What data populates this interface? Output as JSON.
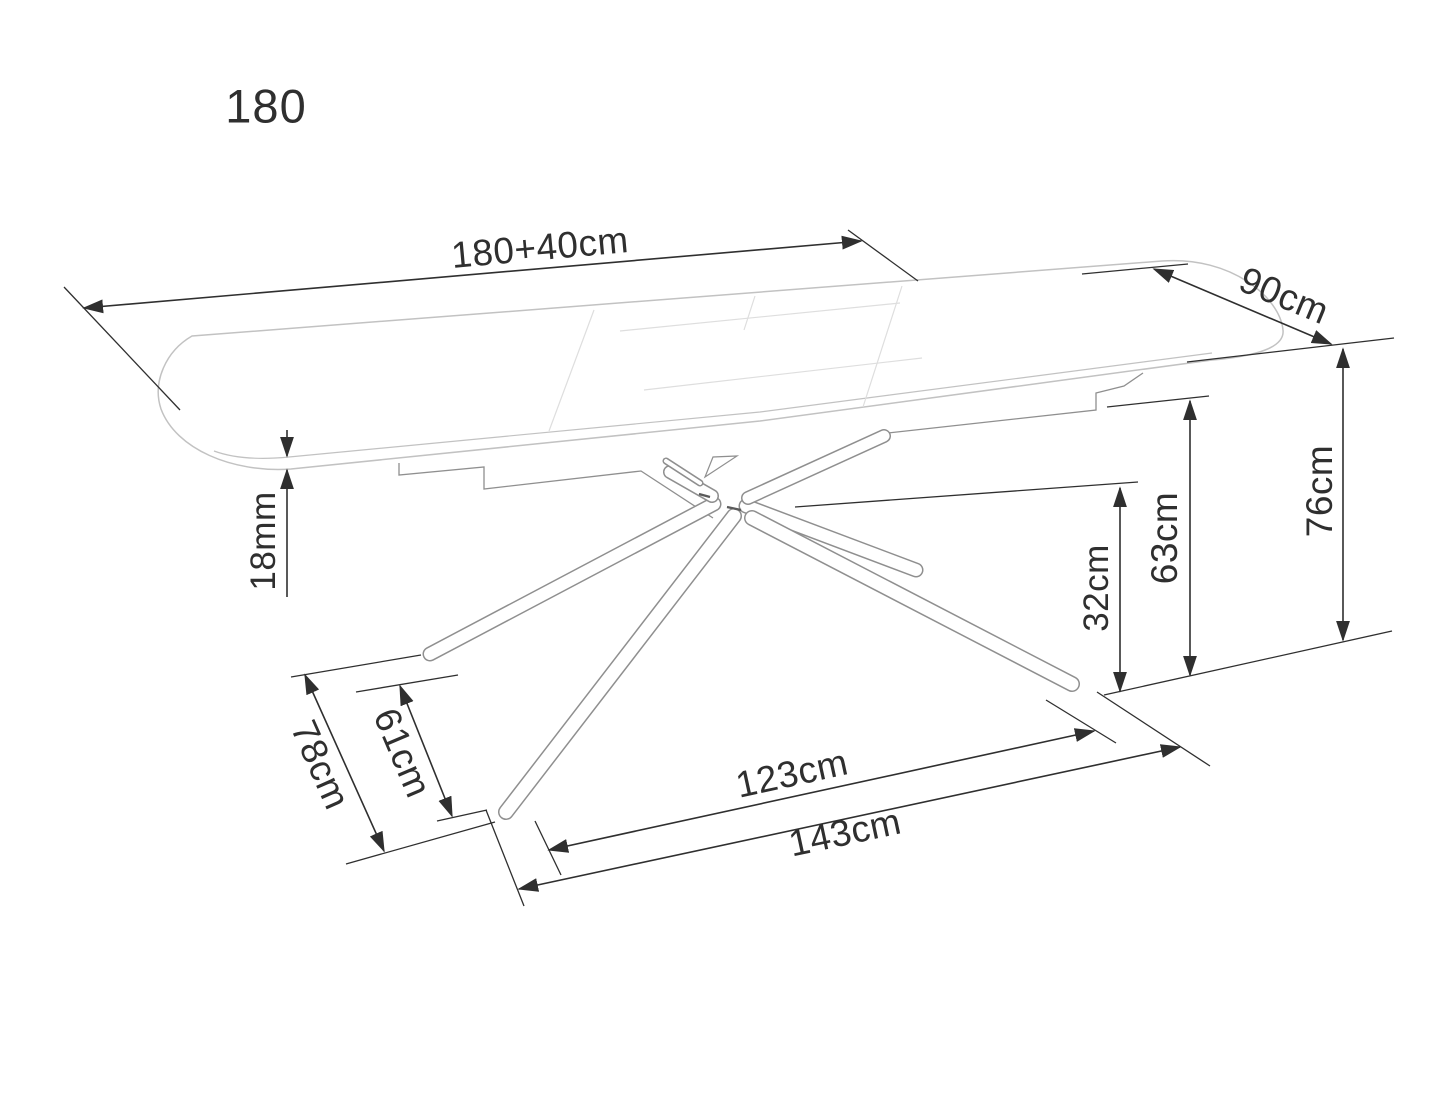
{
  "drawing": {
    "title": "Extendable dining table — dimensional technical drawing",
    "variant_label": "180",
    "dimensions": {
      "length": "180+40cm",
      "depth": "90cm",
      "height": "76cm",
      "base_top_height": "63cm",
      "cross_height": "32cm",
      "top_thickness": "18mm",
      "base_inner_depth": "61cm",
      "base_outer_depth": "78cm",
      "base_inner_length": "123cm",
      "base_outer_length": "143cm"
    }
  },
  "colors": {
    "background": "#ffffff",
    "dimension": "#2f2f2f",
    "outline_strong": "#8f8f8f",
    "outline_light": "#c2c2c2",
    "seam": "#dedede"
  }
}
